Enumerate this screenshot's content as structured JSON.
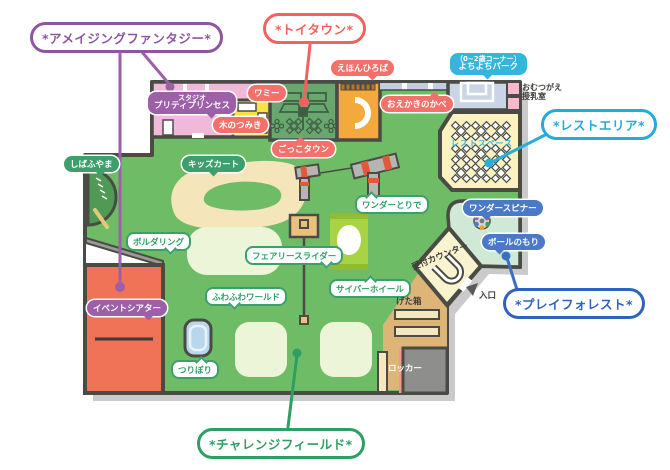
{
  "legend": {
    "amazing_fantasy": "*アメイジングファンタジー*",
    "toy_town": "*トイタウン*",
    "rest_area": "*レストエリア*",
    "play_forest": "*プレイフォレスト*",
    "challenge_field": "*チャレンジフィールド*"
  },
  "areas": {
    "studio_line1": "スタジオ",
    "studio_line2": "プリティプリンセス",
    "wammy": "ワミー",
    "ki_no_tsumiki": "木のつみき",
    "gokko_town": "ごっこタウン",
    "ehon_hiroba": "えほんひろば",
    "oekaki_no_kabe": "おえかきのかべ",
    "yochiyochi_line1": "〔0~2歳コーナー〕",
    "yochiyochi_line2": "よちよちパーク",
    "omutsu_line1": "おむつがえ",
    "omutsu_line2": "授乳室",
    "rest_space": "レストスペース",
    "shibafuyama": "しばふやま",
    "kids_cart": "キッズカート",
    "bouldering": "ボルダリング",
    "event_theater": "イベントシアター",
    "wonder_toride": "ワンダーとりで",
    "fairy_slider": "フェアリースライダー",
    "fuwafuwa_world": "ふわふわワールド",
    "tsuribori": "つりぼり",
    "cyber_wheel": "サイバーホイール",
    "wonder_spinner": "ワンダースピナー",
    "ball_no_mori": "ボールのもり",
    "reception": "受付カウンター",
    "getabako": "げた箱",
    "entrance": "入口",
    "locker": "ロッカー"
  },
  "colors": {
    "floor_green": "#6fbc66",
    "gokko_green": "#68a86f",
    "orange": "#f3a93c",
    "yellow": "#f6e14b",
    "pink_room": "#f0b9d9",
    "rest_cream": "#fbf2c0",
    "ball_forest_green": "#cfe9d6",
    "yochi_blue": "#c9d5e6",
    "entrance_tan": "#dcb577",
    "counter_cream": "#faf3cf",
    "event_red": "#f07257",
    "locker_gray": "#8e8e8c",
    "wall": "#4b4b46",
    "shadow": "#cacaca",
    "accent_purple": "#8e56a0",
    "accent_red": "#f0625f",
    "accent_cyan": "#24aadc",
    "accent_blue": "#2f63c0",
    "accent_green": "#2f9e63"
  },
  "rest_space_tables": {
    "rows": 3,
    "cols": 3
  },
  "gokko_town_icons": {
    "diamond_tables": 2,
    "flower_tables": 2
  }
}
